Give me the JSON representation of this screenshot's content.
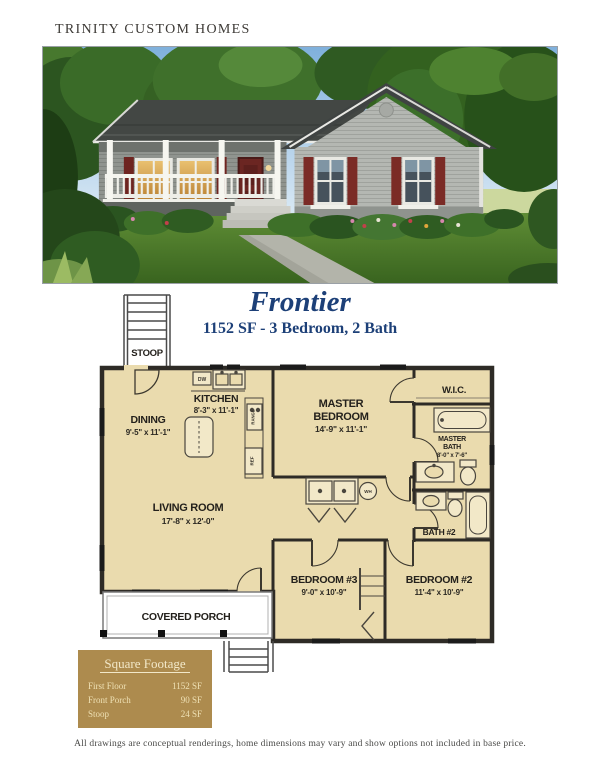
{
  "page": {
    "brand": "TRINITY CUSTOM HOMES",
    "title": "Frontier",
    "subtitle": "1152 SF - 3 Bedroom, 2 Bath",
    "disclaimer": "All drawings are conceptual renderings, home dimensions may vary and show options not included in base price."
  },
  "floor_plan": {
    "stoop": {
      "label": "STOOP"
    },
    "dining": {
      "label": "DINING",
      "dims": "9'-5\" x 11'-1\""
    },
    "kitchen": {
      "label": "KITCHEN",
      "dims": "8'-3\" x 11'-1\""
    },
    "master_bedroom": {
      "line1": "MASTER",
      "line2": "BEDROOM",
      "dims": "14'-9\" x 11'-1\""
    },
    "wic": {
      "label": "W.I.C."
    },
    "master_bath": {
      "line1": "MASTER",
      "line2": "BATH",
      "dims": "8'-0\" x 7'-6\""
    },
    "living_room": {
      "label": "LIVING ROOM",
      "dims": "17'-8\" x 12'-0\""
    },
    "bath2": {
      "label": "BATH #2"
    },
    "bedroom3": {
      "label": "BEDROOM #3",
      "dims": "9'-0\" x 10'-9\""
    },
    "bedroom2": {
      "label": "BEDROOM #2",
      "dims": "11'-4\" x 10'-9\""
    },
    "covered_porch": {
      "label": "COVERED PORCH"
    },
    "fixtures": {
      "dishwasher": "DW",
      "range": "RANGE",
      "refrigerator": "REF",
      "water_heater": "WH"
    }
  },
  "square_footage": {
    "title": "Square Footage",
    "rows": [
      {
        "label": "First Floor",
        "value": "1152 SF"
      },
      {
        "label": "Front Porch",
        "value": "90 SF"
      },
      {
        "label": "Stoop",
        "value": "24 SF"
      }
    ]
  },
  "colors": {
    "navy": "#1d4078",
    "plan_floor": "#eadbae",
    "gold_box": "#ad8b4e",
    "shutter_red": "#7b2b26"
  }
}
